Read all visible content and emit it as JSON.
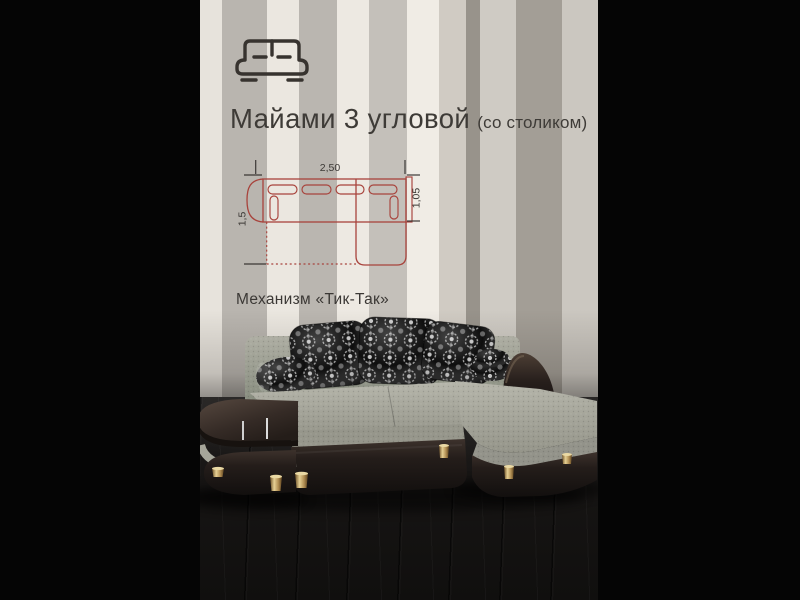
{
  "frame": {
    "bar_color": "#050505"
  },
  "wall": {
    "stripes": [
      {
        "color": "#e7e3dc",
        "width": 22
      },
      {
        "color": "#b9b5af",
        "width": 45
      },
      {
        "color": "#ebe7e0",
        "width": 32
      },
      {
        "color": "#bab6b0",
        "width": 38
      },
      {
        "color": "#ede9e2",
        "width": 32
      },
      {
        "color": "#c4c0ba",
        "width": 38
      },
      {
        "color": "#f0ece5",
        "width": 32
      },
      {
        "color": "#d0cbc3",
        "width": 27
      },
      {
        "color": "#98938b",
        "width": 14
      },
      {
        "color": "#cfcbc4",
        "width": 36
      },
      {
        "color": "#a39e96",
        "width": 46
      },
      {
        "color": "#cbc7c0",
        "width": 36
      }
    ]
  },
  "header": {
    "icon": "sofa-outline-icon",
    "title": "Майами 3 угловой",
    "subtitle": "(со столиком)",
    "text_color": "#3e3b37"
  },
  "diagram": {
    "accent_color": "#a8433c",
    "label_color": "#3b3835",
    "width_label": "2,50",
    "right_depth_label": "1,05",
    "left_depth_label": "1,5"
  },
  "mechanism": {
    "label": "Механизм «Тик-Так»"
  },
  "photo": {
    "fabric_color": "#a3a399",
    "leather_color": "#2b2422",
    "pillow_base_color": "#0e0e0e",
    "pillow_pattern_color": "#c4c4c4",
    "legs_color": "#b08d52",
    "floor_color": "#161413"
  }
}
